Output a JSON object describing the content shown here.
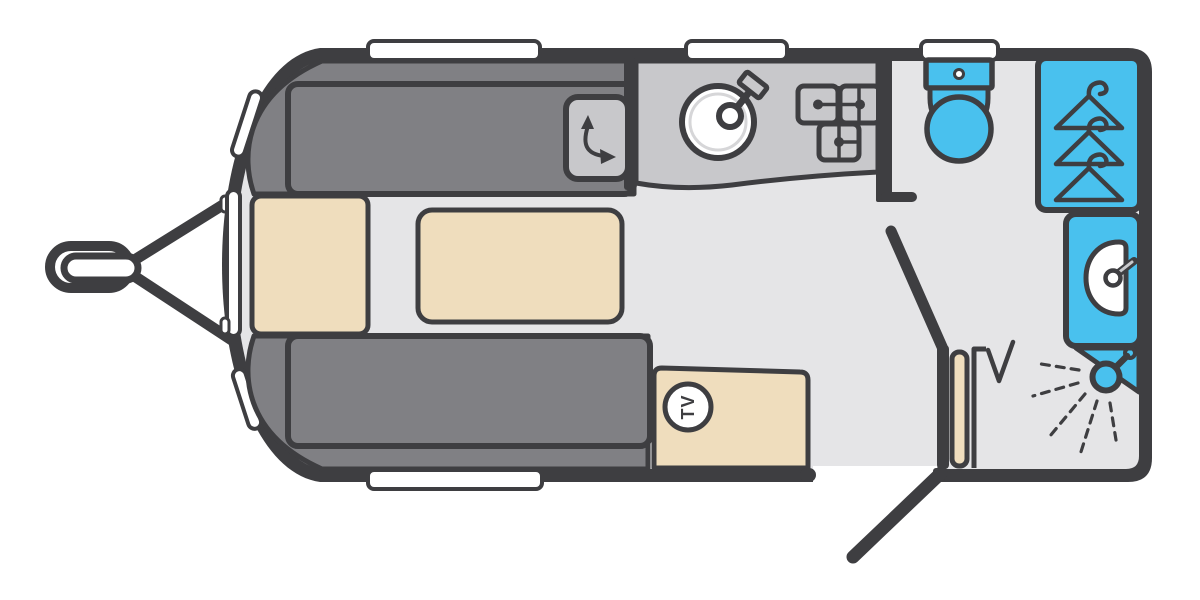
{
  "diagram": {
    "type": "caravan-floorplan",
    "orientation": "hitch-left",
    "labels": {
      "tv": "TV"
    },
    "colors": {
      "dark": "#3e3e41",
      "floor": "#e5e5e7",
      "sofa": "#808084",
      "counter": "#c8c8cb",
      "cream": "#efddbd",
      "blue": "#49c1ee",
      "white": "#ffffff",
      "ring": "#d6d6d8",
      "bg": "#ffffff"
    },
    "zones": [
      {
        "name": "front-lounge",
        "items": [
          "sofa-top",
          "sofa-bottom",
          "front-chest",
          "table",
          "swivel-unit",
          "tv-cabinet"
        ]
      },
      {
        "name": "kitchen",
        "items": [
          "worktop",
          "sink-with-tap",
          "hob-3-burner"
        ]
      },
      {
        "name": "washroom",
        "items": [
          "toilet",
          "wardrobe-with-hangers",
          "washbasin-with-tap",
          "corner-shower"
        ]
      }
    ],
    "openings": {
      "entrance-door": "bottom wall, shown open outward",
      "washroom-door": "interior sliding/angled partition with folding screen",
      "windows_top": 3,
      "windows_bottom": 1,
      "windows_front": 3
    }
  }
}
